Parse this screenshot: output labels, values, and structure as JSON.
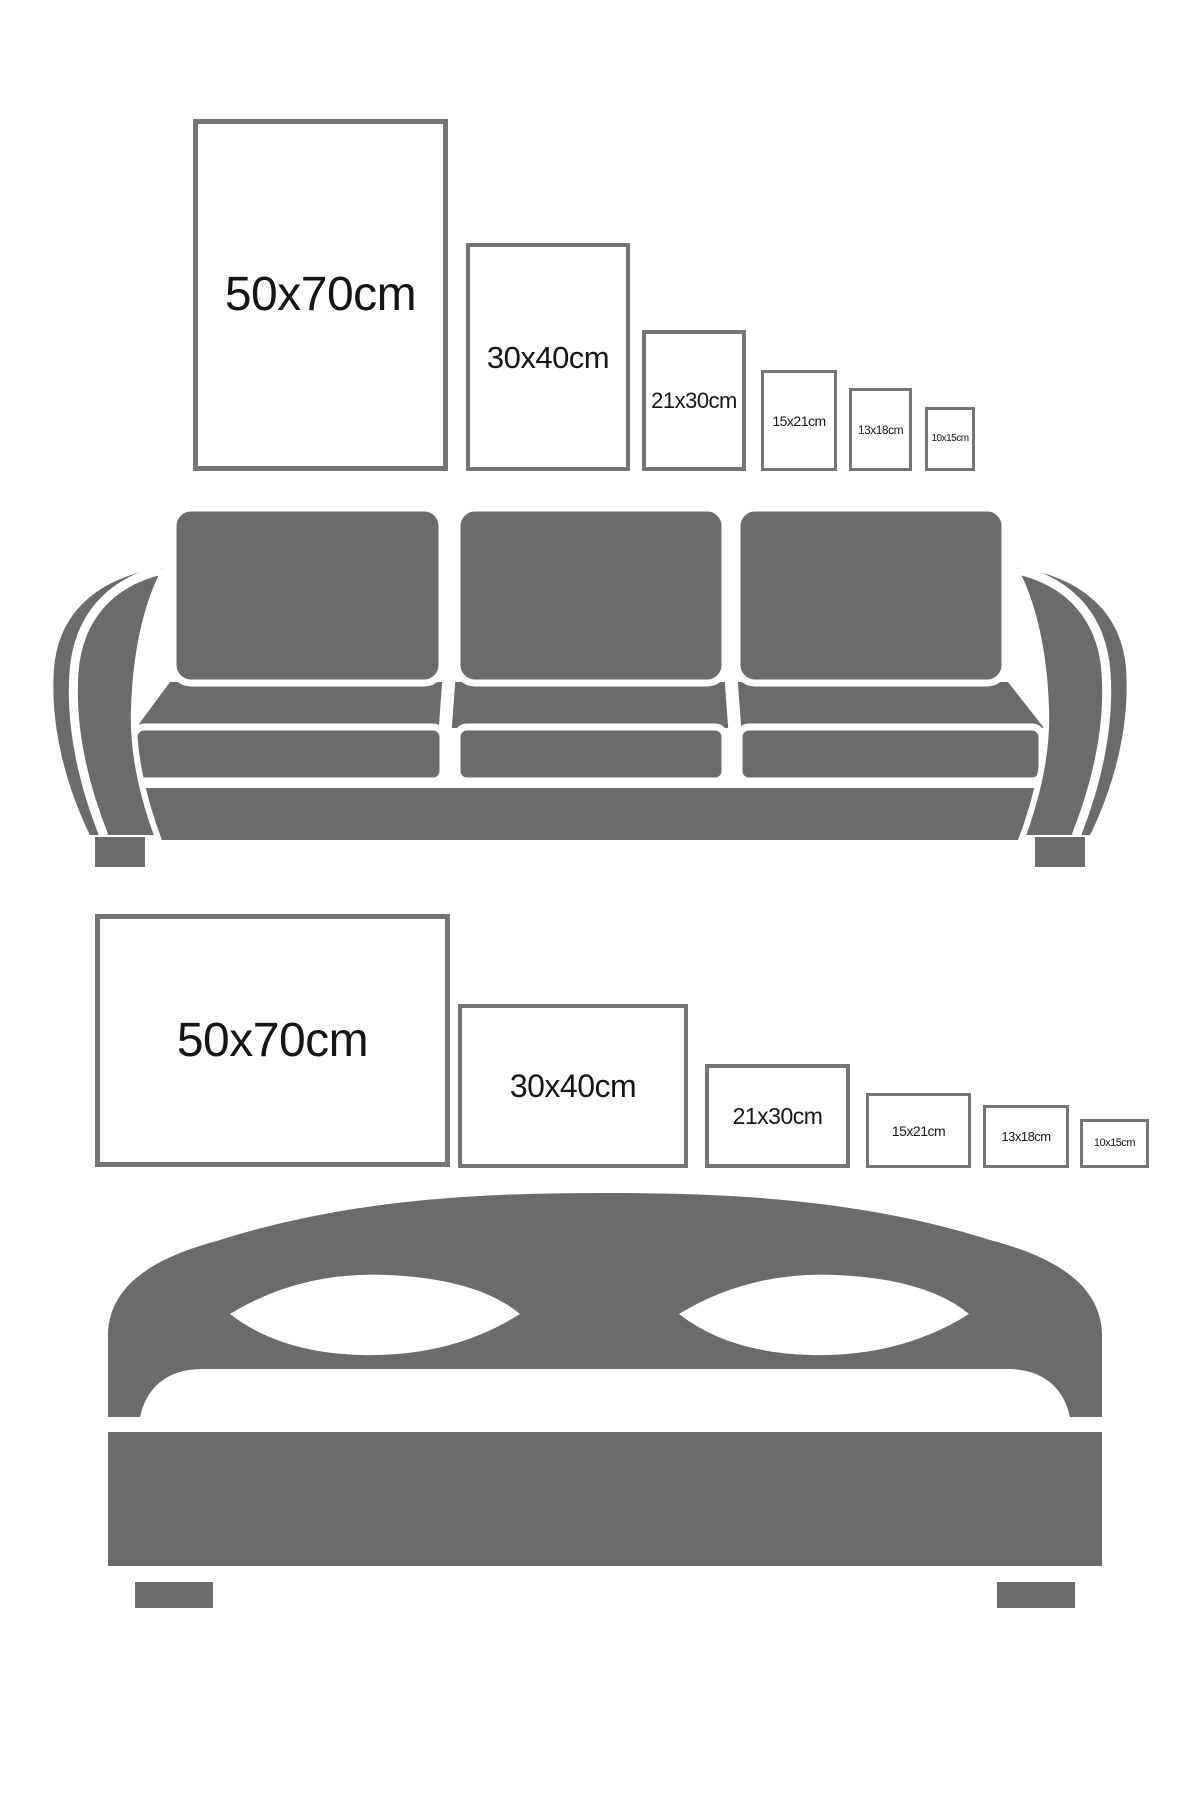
{
  "colors": {
    "furniture": "#6b6b6b",
    "frame_border": "#757575",
    "text": "#151515",
    "background": "#ffffff"
  },
  "top_section": {
    "furniture_icon": "sofa",
    "orientation": "portrait",
    "frames": [
      {
        "label": "50x70cm"
      },
      {
        "label": "30x40cm"
      },
      {
        "label": "21x30cm"
      },
      {
        "label": "15x21cm"
      },
      {
        "label": "13x18cm"
      },
      {
        "label": "10x15cm"
      }
    ]
  },
  "bottom_section": {
    "furniture_icon": "bed",
    "orientation": "landscape",
    "frames": [
      {
        "label": "50x70cm"
      },
      {
        "label": "30x40cm"
      },
      {
        "label": "21x30cm"
      },
      {
        "label": "15x21cm"
      },
      {
        "label": "13x18cm"
      },
      {
        "label": "10x15cm"
      }
    ]
  }
}
